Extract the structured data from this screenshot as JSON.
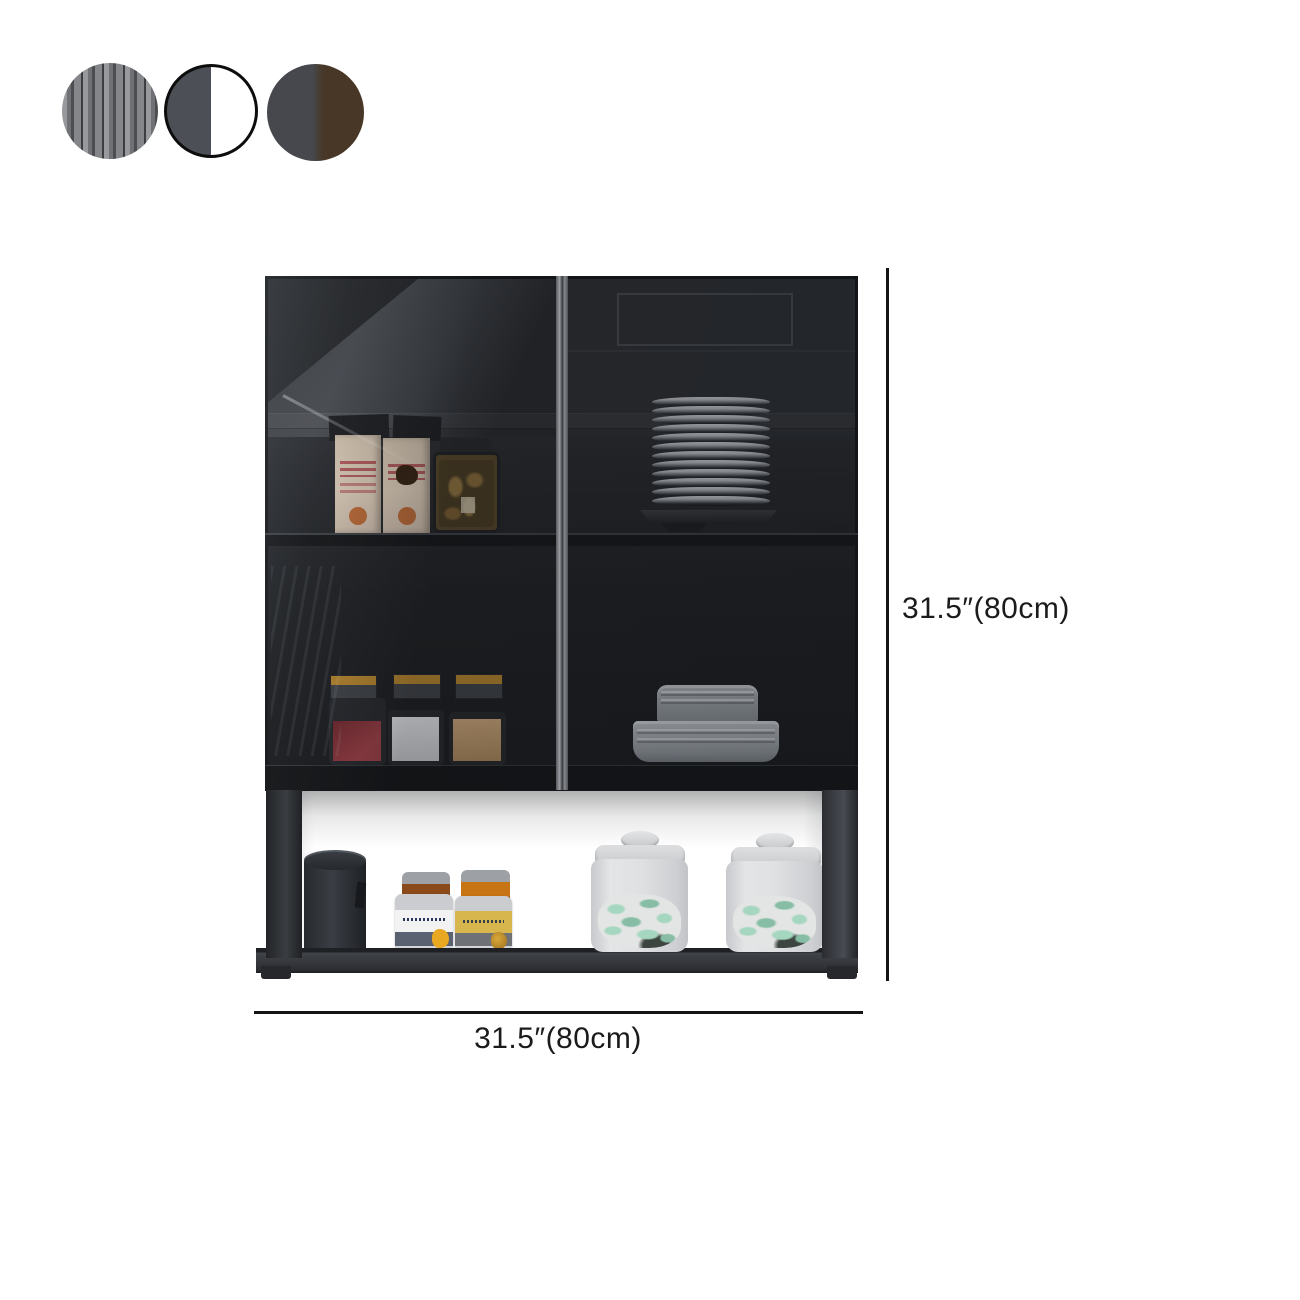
{
  "canvas": {
    "background": "#ffffff"
  },
  "swatches": [
    {
      "id": "fluted-glass-gray",
      "type": "stripes",
      "stripe_colors": [
        "#97999c",
        "#6f7174",
        "#4b4d50",
        "#848689",
        "#3b3d40"
      ]
    },
    {
      "id": "gray-and-white",
      "type": "split",
      "soft": false,
      "left_color": "#4c4f55",
      "right_color": "#ffffff",
      "ring_color": "#0d0d0d"
    },
    {
      "id": "gray-and-walnut",
      "type": "split",
      "soft": true,
      "left_color": "#46484d",
      "right_color": "#483726",
      "ring_color": ""
    }
  ],
  "dimensions": {
    "height_label": "31.5″(80cm)",
    "width_label": "31.5″(80cm)",
    "line_color": "#141414",
    "text_color": "#1b1b1b"
  },
  "scene": {
    "description": "Black wall-mounted kitchen hutch with two smoked-glass doors above an open display shelf",
    "plates_count": 12,
    "items": {
      "upper_left": "snack boxes and a jar of crackers",
      "upper_right": "stack of dinner plates",
      "lower_left": "red, white and tan storage canisters with spice jars",
      "lower_right": "stack of bowls",
      "shelf": "dark canister, two spice jars, two frosted jars of green pasta"
    },
    "colors": {
      "frame": "#131416",
      "glass_tint": "#1e2024",
      "pasta": "#a5d6bf",
      "pasta_dark": "#86bda4"
    }
  }
}
